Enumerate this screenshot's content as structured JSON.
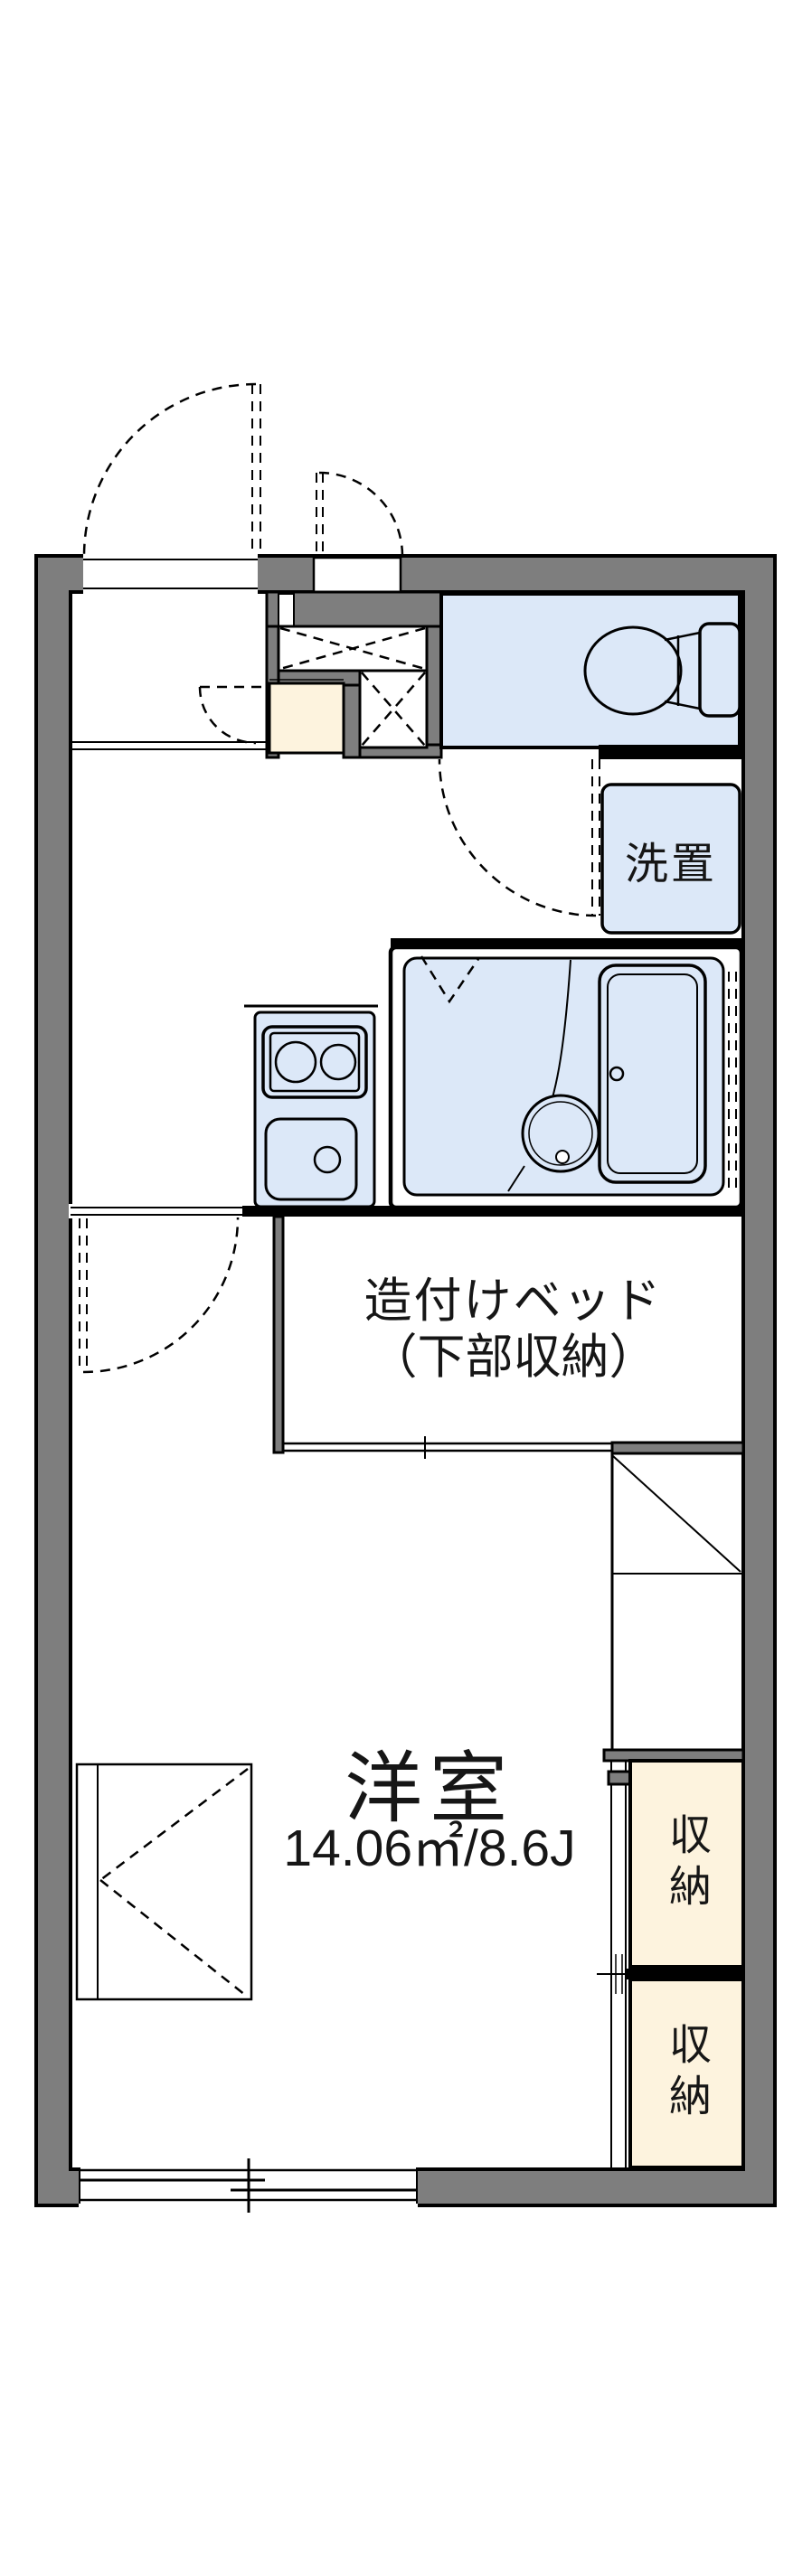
{
  "colors": {
    "background": "#ffffff",
    "wall": "#7e7e7e",
    "line": "#000000",
    "fixture": "#dce8f8",
    "storage": "#fdf3de"
  },
  "floor_plan": {
    "laundry_label": "洗置",
    "bed_label_line1": "造付けベッド",
    "bed_label_line2": "（下部収納）",
    "room_name": "洋室",
    "room_area": "14.06㎡/8.6J",
    "storage_upper_label": "収納",
    "storage_lower_label": "収納"
  }
}
